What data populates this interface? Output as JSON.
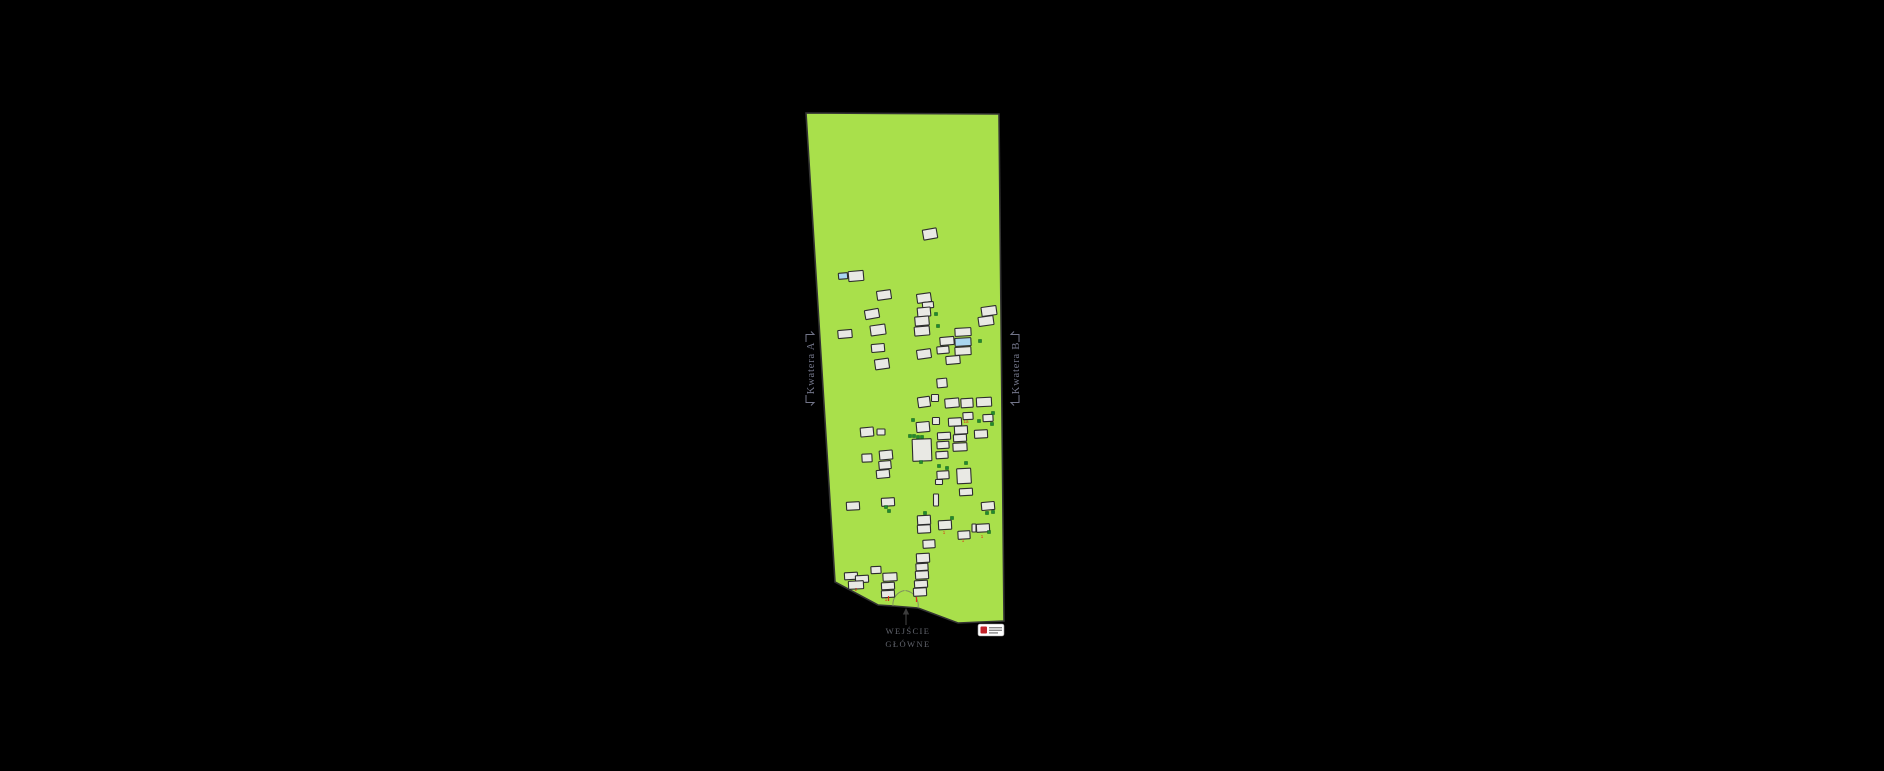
{
  "page": {
    "background": "#000000"
  },
  "map": {
    "ground_fill": "#a9e04b",
    "ground_stroke": "#333333",
    "outline": [
      [
        806,
        113
      ],
      [
        999,
        114
      ],
      [
        1004,
        621
      ],
      [
        958,
        623
      ],
      [
        918,
        608
      ],
      [
        893,
        606
      ],
      [
        878,
        605
      ],
      [
        835,
        582
      ]
    ]
  },
  "labels": {
    "quarter_a": "Kwatera A",
    "quarter_b": "Kwatera B",
    "color": "#73768a"
  },
  "entrance": {
    "line1": "WEJŚCIE",
    "line2": "GŁÓWNE",
    "color": "#63666f",
    "arrow_color": "#3c3c3c"
  },
  "plots": {
    "fill": "#e9e9e4",
    "blue_fill": "#a9d6f0",
    "stroke": "#2d2d2d",
    "items": [
      [
        930,
        234,
        14,
        10,
        -10
      ],
      [
        843,
        276,
        9,
        6,
        -5,
        "b"
      ],
      [
        856,
        276,
        15,
        10,
        -5
      ],
      [
        884,
        295,
        14,
        9,
        -8
      ],
      [
        924,
        298,
        14,
        9,
        -8
      ],
      [
        928,
        305,
        11,
        6,
        -5
      ],
      [
        924,
        312,
        13,
        9,
        -5
      ],
      [
        872,
        314,
        14,
        9,
        -10
      ],
      [
        922,
        321,
        14,
        9,
        -5
      ],
      [
        989,
        311,
        15,
        9,
        -8
      ],
      [
        986,
        321,
        15,
        9,
        -8
      ],
      [
        878,
        330,
        15,
        10,
        -8
      ],
      [
        845,
        334,
        14,
        8,
        -5
      ],
      [
        922,
        331,
        15,
        9,
        -5
      ],
      [
        947,
        341,
        14,
        8,
        -5
      ],
      [
        963,
        332,
        16,
        8,
        -3
      ],
      [
        963,
        342,
        16,
        8,
        -3,
        "b"
      ],
      [
        963,
        351,
        16,
        8,
        -3
      ],
      [
        943,
        350,
        12,
        7,
        -5
      ],
      [
        878,
        348,
        13,
        8,
        -5
      ],
      [
        924,
        354,
        14,
        9,
        -8
      ],
      [
        882,
        364,
        14,
        10,
        -8
      ],
      [
        953,
        360,
        14,
        8,
        -5
      ],
      [
        942,
        383,
        10,
        9,
        -5
      ],
      [
        924,
        402,
        12,
        10,
        -8
      ],
      [
        935,
        398,
        7,
        7,
        0
      ],
      [
        952,
        403,
        14,
        9,
        -5
      ],
      [
        967,
        403,
        12,
        9,
        -3
      ],
      [
        984,
        402,
        15,
        9,
        -3
      ],
      [
        936,
        421,
        7,
        7,
        0
      ],
      [
        923,
        427,
        13,
        10,
        -5
      ],
      [
        955,
        422,
        13,
        8,
        -3
      ],
      [
        968,
        416,
        10,
        7,
        -3
      ],
      [
        988,
        418,
        10,
        7,
        -3
      ],
      [
        961,
        430,
        13,
        8,
        -3
      ],
      [
        981,
        434,
        13,
        8,
        -3
      ],
      [
        867,
        432,
        13,
        9,
        -5
      ],
      [
        881,
        432,
        8,
        6,
        0
      ],
      [
        944,
        436,
        13,
        7,
        -3
      ],
      [
        960,
        438,
        13,
        7,
        -3
      ],
      [
        922,
        450,
        19,
        22,
        -2
      ],
      [
        943,
        445,
        12,
        7,
        -3
      ],
      [
        960,
        447,
        14,
        8,
        -3
      ],
      [
        942,
        455,
        12,
        7,
        -3
      ],
      [
        867,
        458,
        10,
        8,
        -3
      ],
      [
        886,
        455,
        13,
        9,
        -5
      ],
      [
        885,
        465,
        12,
        8,
        -5
      ],
      [
        943,
        475,
        12,
        8,
        -3
      ],
      [
        883,
        474,
        13,
        8,
        -5
      ],
      [
        964,
        476,
        14,
        15,
        -3
      ],
      [
        966,
        492,
        13,
        7,
        -3
      ],
      [
        939,
        482,
        7,
        5,
        0
      ],
      [
        853,
        506,
        13,
        8,
        -3
      ],
      [
        888,
        502,
        13,
        8,
        -3
      ],
      [
        936,
        500,
        5,
        12,
        0
      ],
      [
        988,
        506,
        13,
        8,
        -5
      ],
      [
        924,
        520,
        13,
        9,
        -3
      ],
      [
        924,
        529,
        13,
        8,
        -3
      ],
      [
        945,
        525,
        13,
        9,
        -3
      ],
      [
        964,
        535,
        12,
        8,
        -3
      ],
      [
        974,
        528,
        4,
        8,
        0
      ],
      [
        983,
        528,
        13,
        8,
        -3
      ],
      [
        929,
        544,
        12,
        8,
        -3
      ],
      [
        923,
        558,
        13,
        9,
        -3
      ],
      [
        922,
        567,
        12,
        7,
        -3
      ],
      [
        922,
        575,
        13,
        8,
        -3
      ],
      [
        921,
        584,
        13,
        7,
        -3
      ],
      [
        920,
        592,
        13,
        8,
        -3
      ],
      [
        851,
        576,
        13,
        7,
        -3
      ],
      [
        862,
        579,
        13,
        7,
        -3
      ],
      [
        856,
        585,
        15,
        8,
        -3
      ],
      [
        876,
        570,
        10,
        7,
        -3
      ],
      [
        890,
        577,
        14,
        8,
        -3
      ],
      [
        888,
        586,
        13,
        7,
        -3
      ],
      [
        888,
        594,
        13,
        7,
        -3
      ]
    ]
  },
  "trees": {
    "color": "#1f8c2e",
    "edge": "#0f5a1d",
    "items": [
      [
        936,
        314
      ],
      [
        938,
        326
      ],
      [
        980,
        341
      ],
      [
        913,
        420
      ],
      [
        979,
        421
      ],
      [
        992,
        424
      ],
      [
        993,
        413
      ],
      [
        910,
        436
      ],
      [
        914,
        436
      ],
      [
        918,
        437
      ],
      [
        922,
        437
      ],
      [
        921,
        462
      ],
      [
        966,
        463
      ],
      [
        939,
        466
      ],
      [
        947,
        468
      ],
      [
        886,
        507
      ],
      [
        889,
        511
      ],
      [
        925,
        513
      ],
      [
        952,
        518
      ],
      [
        987,
        513
      ],
      [
        993,
        512
      ],
      [
        989,
        532
      ]
    ]
  },
  "marks": {
    "color": "#e03018",
    "items": [
      [
        966,
        423,
        "1a"
      ],
      [
        944,
        534,
        "1"
      ],
      [
        963,
        542,
        "1"
      ],
      [
        982,
        538,
        "1"
      ],
      [
        856,
        591,
        "2"
      ],
      [
        886,
        601,
        "1"
      ]
    ],
    "gate_ticks": [
      [
        888.5,
        600
      ],
      [
        916.5,
        601
      ]
    ]
  },
  "watermark": {
    "icon": "red-logo-mark",
    "box_fill": "#ffffff",
    "box_stroke": "#999999",
    "mark_color": "#c2232a",
    "text_line_color": "#8a8a8a"
  }
}
